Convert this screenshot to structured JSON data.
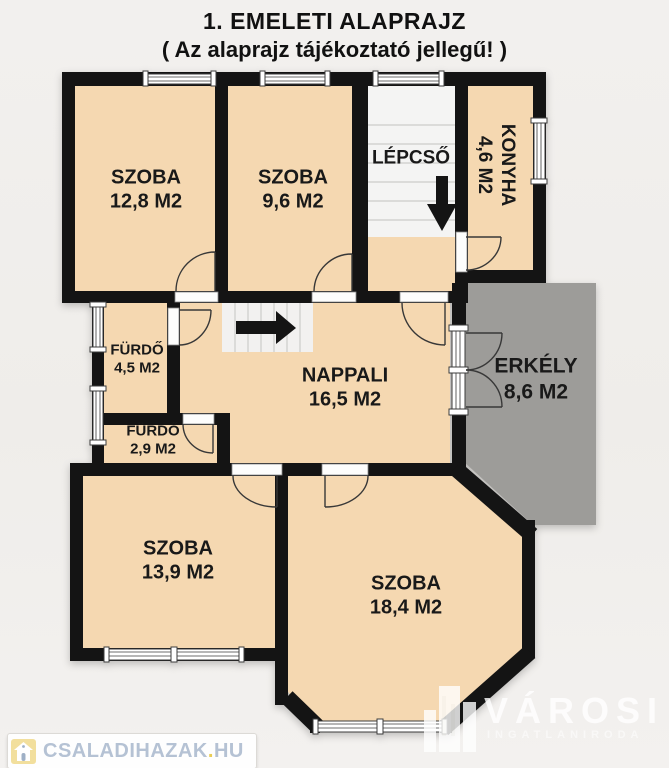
{
  "title": {
    "line1": "1. EMELETI ALAPRAJZ",
    "line2": "( Az alaprajz tájékoztató jellegű! )"
  },
  "rooms": {
    "szoba1": {
      "name": "SZOBA",
      "area": "12,8 M2"
    },
    "szoba2": {
      "name": "SZOBA",
      "area": "9,6 M2"
    },
    "lepcso": {
      "name": "LÉPCSŐ"
    },
    "konyha": {
      "name": "KONYHA",
      "area": "4,6 M2"
    },
    "furdo1": {
      "name": "FÜRDŐ",
      "area": "4,5 M2"
    },
    "furdo2": {
      "name": "FÜRDŐ",
      "area": "2,9 M2"
    },
    "nappali": {
      "name": "NAPPALI",
      "area": "16,5 M2"
    },
    "erkely": {
      "name": "ERKÉLY",
      "area": "8,6 M2"
    },
    "szoba3": {
      "name": "SZOBA",
      "area": "13,9 M2"
    },
    "szoba4": {
      "name": "SZOBA",
      "area": "18,4 M2"
    }
  },
  "watermarks": {
    "left": {
      "text": "CSALADIHAZAK",
      "dot": ".",
      "tld": "HU"
    },
    "right": {
      "brand": "VÁROSI",
      "sub": "INGATLANIRODA"
    }
  },
  "colors": {
    "wall": "#141414",
    "room_fill": "#f5d8b1",
    "stair_fill": "#f4f4f3",
    "balcony_fill": "#9d9c99",
    "background": "#f1efec",
    "label_text": "#191919",
    "watermark_blue": "#b5c2d4",
    "watermark_gold": "#e9cd56"
  }
}
